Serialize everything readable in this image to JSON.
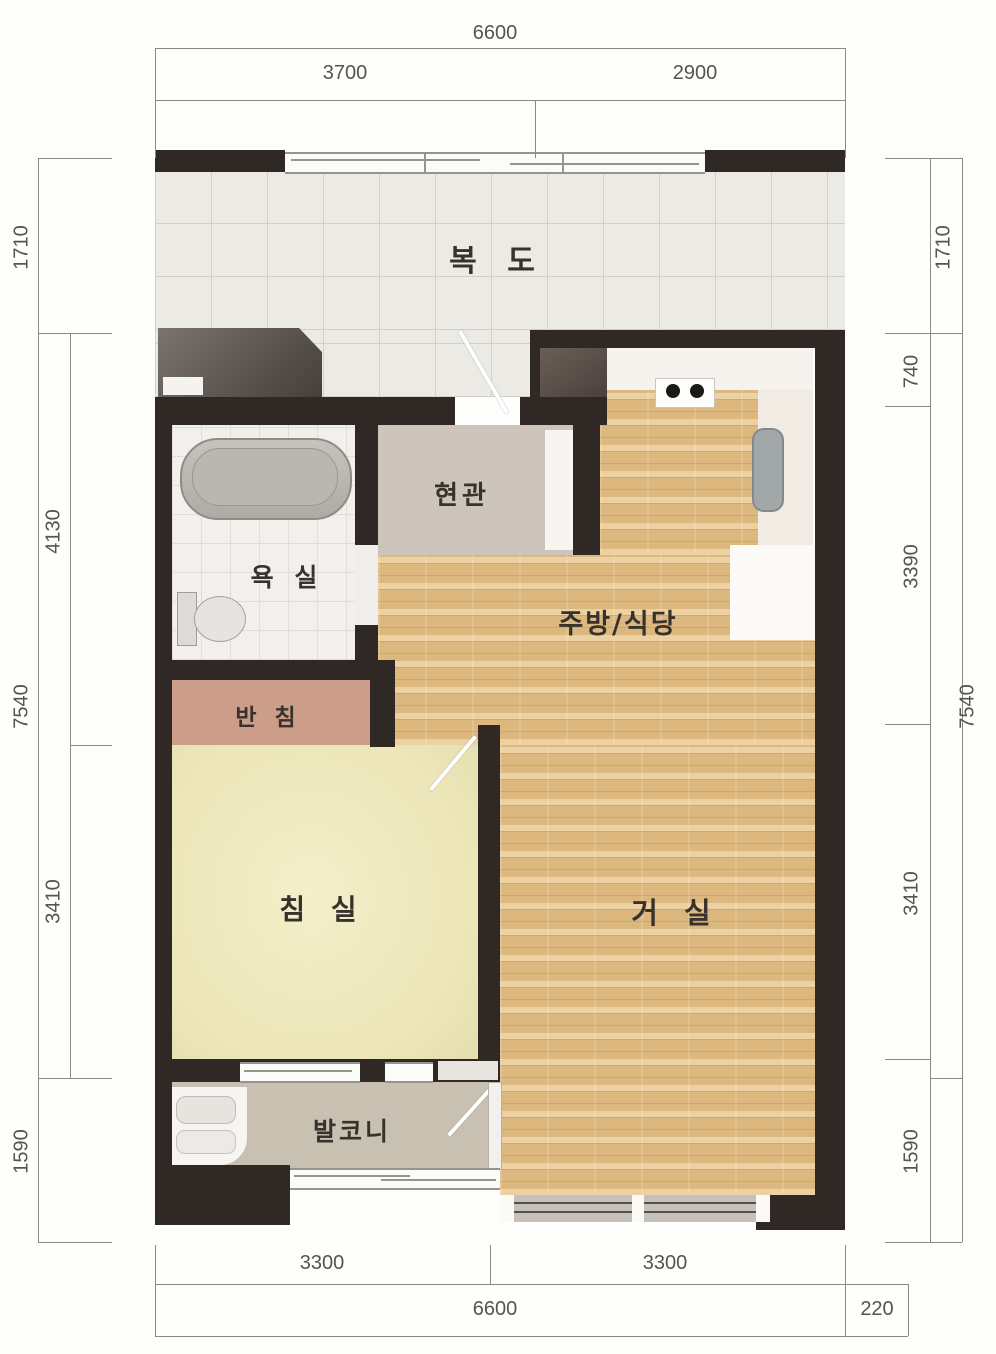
{
  "plan_title": "1-bedroom apartment unit floor plan",
  "rooms": {
    "corridor": "복 도",
    "entrance": "현관",
    "bathroom": "욕 실",
    "kitchen_dining": "주방/식당",
    "closet": "반 침",
    "bedroom": "침 실",
    "living": "거 실",
    "balcony": "발코니"
  },
  "dims": {
    "top": {
      "overall": "6600",
      "left": "3700",
      "right": "2900"
    },
    "bottom": {
      "left": "3300",
      "right": "3300",
      "overall": "6600",
      "offset": "220"
    },
    "left_outer": [
      "1710",
      "7540",
      "1590"
    ],
    "left_inner": [
      "4130",
      "3410"
    ],
    "right_inner": [
      "1710",
      "740",
      "3390",
      "3410",
      "1590"
    ],
    "right_outer": [
      "7540"
    ]
  },
  "colors": {
    "wall": "#2f2824",
    "wood_floor": "#dcb87f",
    "bedroom_floor": "#efe9c1",
    "closet_floor": "#cc9d88",
    "corridor_tile": "#eceae5",
    "balcony_floor": "#c8c0b1",
    "entrance_floor": "#cdc5bc",
    "dimension_text": "#56544f"
  }
}
